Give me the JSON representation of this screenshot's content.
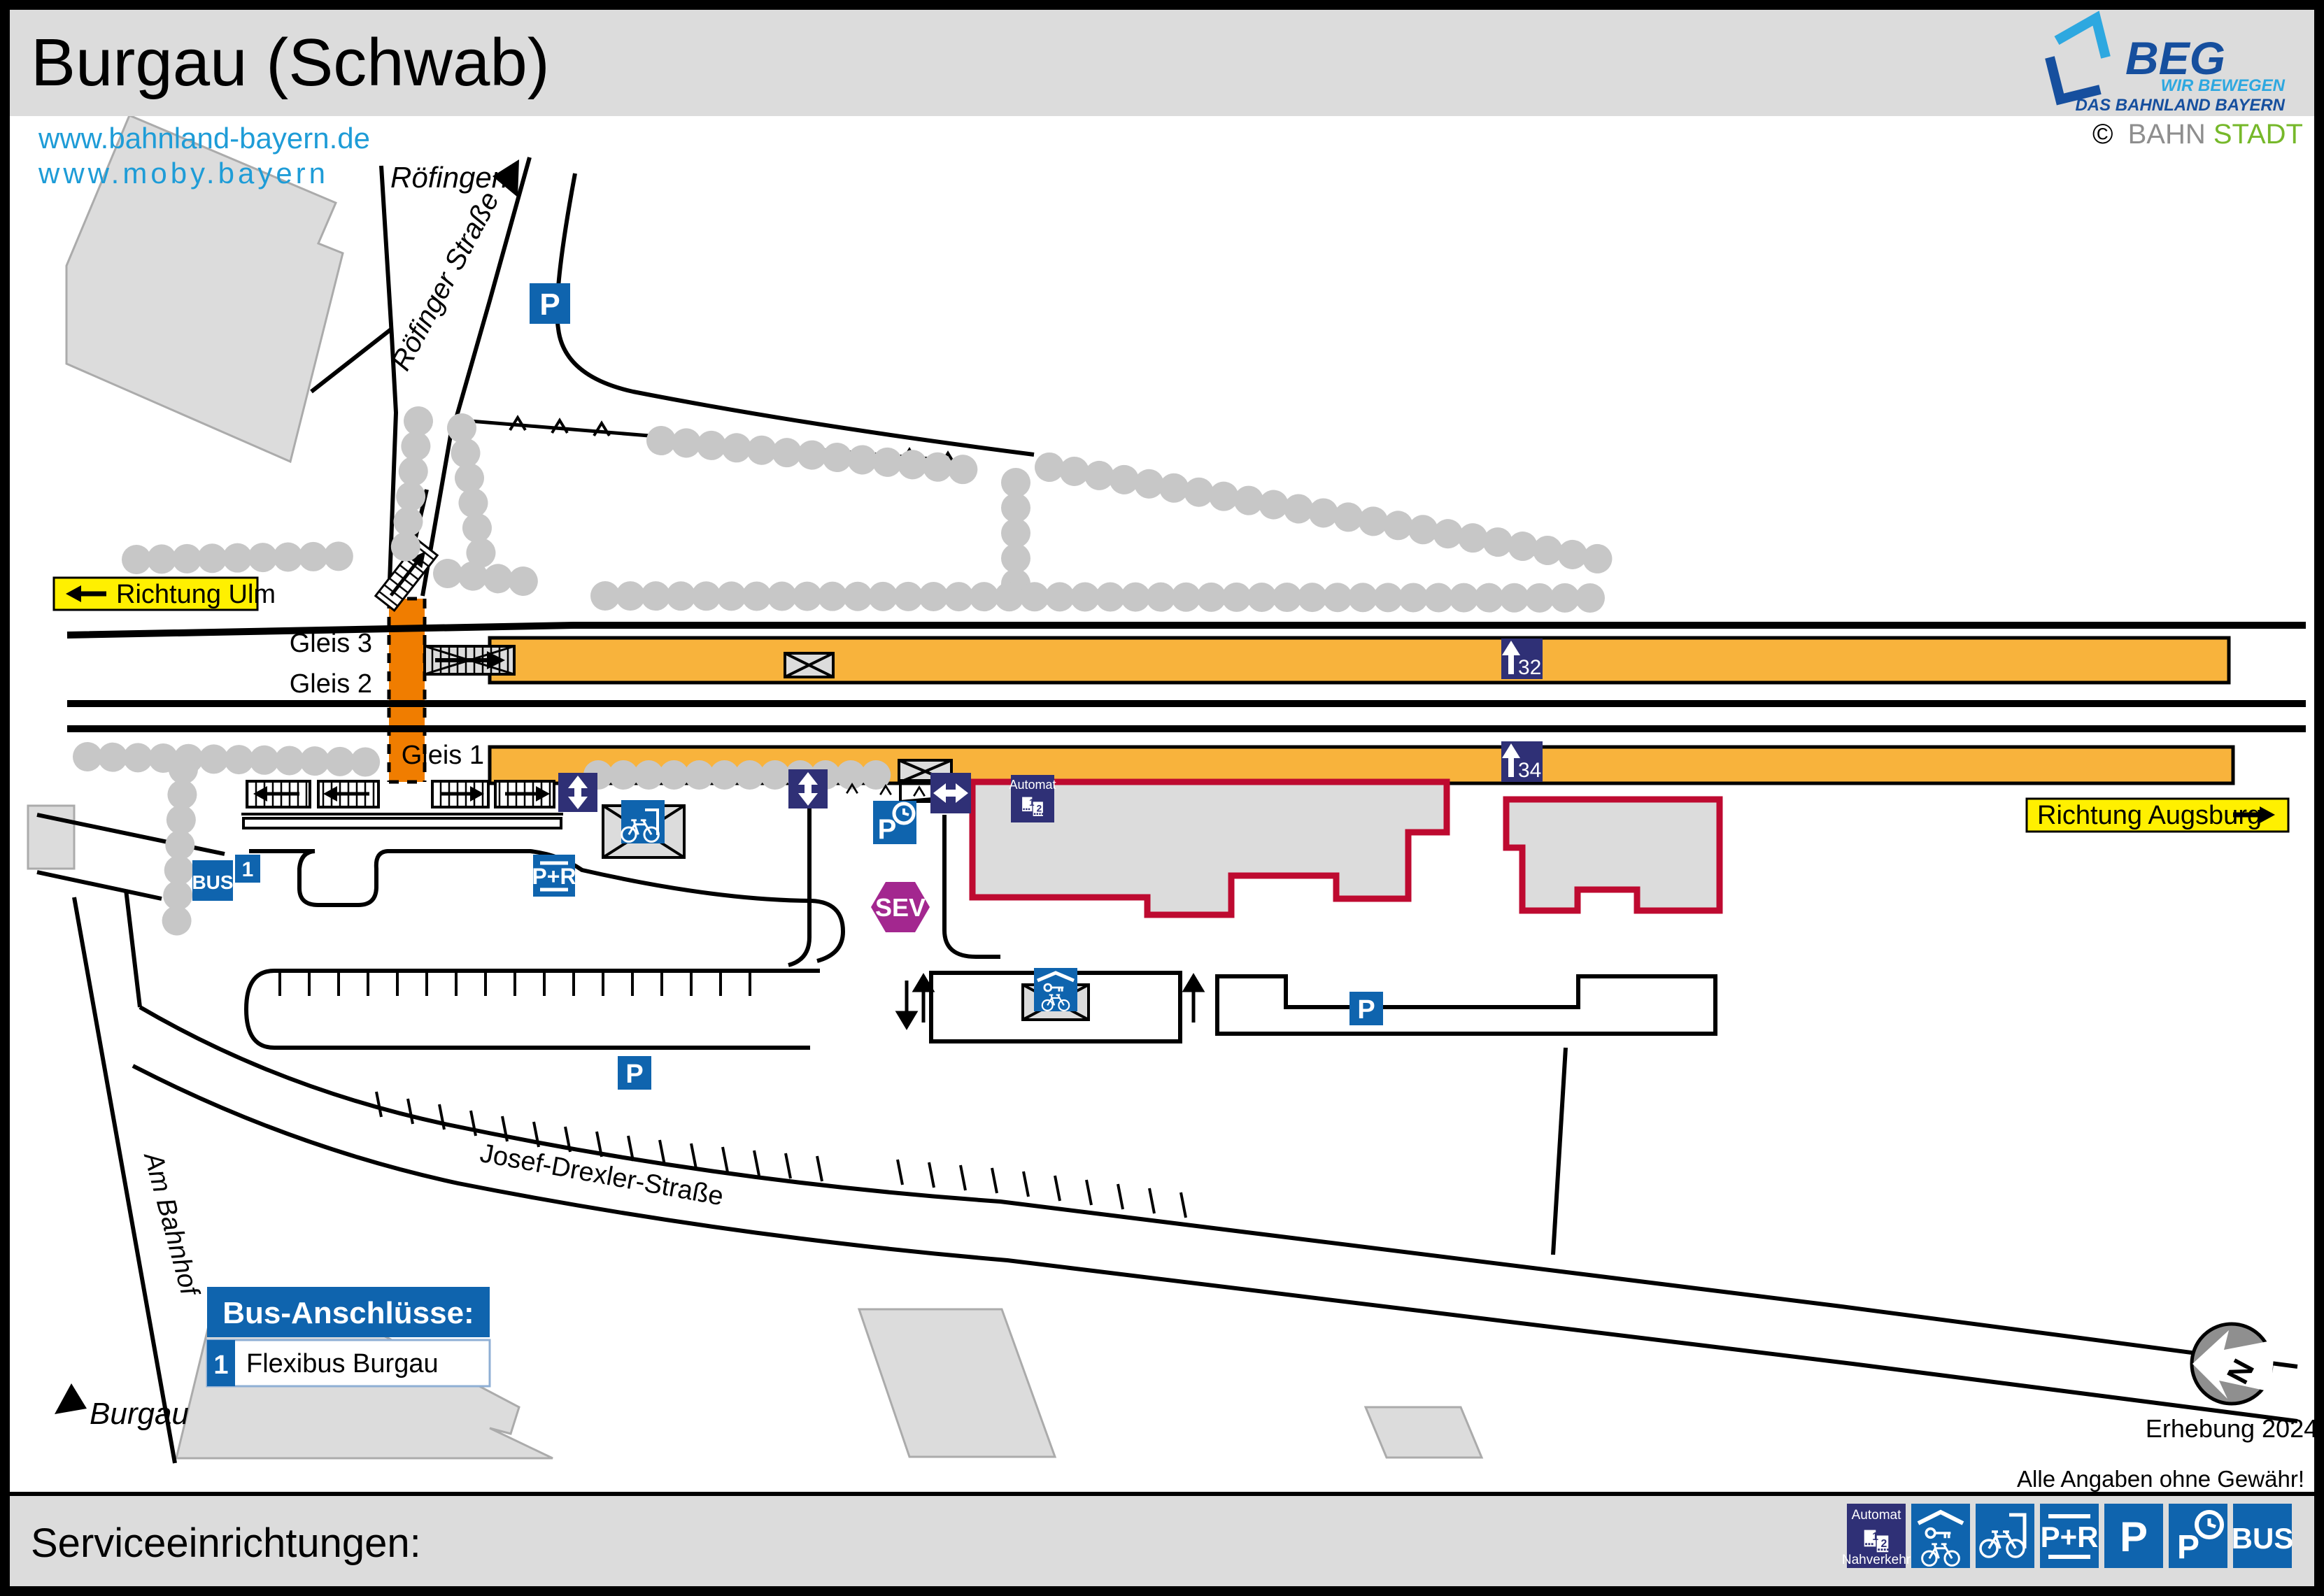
{
  "header": {
    "title": "Burgau (Schwab)"
  },
  "logo": {
    "name": "BEG",
    "tagline1": "WIR BEWEGEN",
    "tagline2": "DAS BAHNLAND BAYERN"
  },
  "credit": {
    "symbol": "©",
    "gray": "BAHN",
    "green": "STADT"
  },
  "links": {
    "line1": "www.bahnland-bayern.de",
    "line2": "www.moby.bayern"
  },
  "map": {
    "signs": {
      "ulm": "Richtung Ulm",
      "augsburg": "Richtung Augsburg"
    },
    "places": {
      "north": "Röfingen",
      "south": "Burgau"
    },
    "streets": {
      "roefinger": "Röfinger Straße",
      "josef_drexler": "Josef-Drexler-Straße",
      "am_bahnhof": "Am Bahnhof"
    },
    "tracks": {
      "g1": "Gleis 1",
      "g2": "Gleis 2",
      "g3": "Gleis 3"
    },
    "platform_signs": {
      "s32": "32",
      "s34": "34"
    },
    "icons": {
      "parking": "P",
      "park_ride": "P+R",
      "bus": "BUS",
      "bus_line": "1",
      "sev": "SEV",
      "automat": "Automat"
    },
    "bus_connections": {
      "title": "Bus-Anschlüsse:",
      "rows": [
        {
          "number": "1",
          "label": "Flexibus Burgau"
        }
      ]
    },
    "compass": {
      "north": "N",
      "survey": "Erhebung 2024"
    },
    "disclaimer": "Alle Angaben ohne Gewähr!"
  },
  "footer": {
    "title": "Serviceeinrichtungen:",
    "icons": {
      "automat_top": "Automat",
      "automat_bottom": "Nahverkehr",
      "park_ride": "P+R",
      "parking": "P",
      "bus": "BUS"
    }
  },
  "glyphs": {
    "machine1": "1",
    "machine2": "2"
  },
  "colors": {
    "platform": "#F8B33C",
    "crossing": "#F07D00",
    "icon_blue": "#0F64AE",
    "icon_navy": "#2F3076",
    "sev_purple": "#A3278F",
    "building_outline": "#BE0A30",
    "building_fill": "#DCDCDC",
    "sign_yellow": "#FFF000",
    "link_blue": "#1E9CD7",
    "beg_dark": "#164F9E",
    "beg_light": "#2EA8E0",
    "stadt_green": "#76B82A",
    "bar_gray": "#DCDCDC",
    "hedge_gray": "#C7C7C7"
  }
}
